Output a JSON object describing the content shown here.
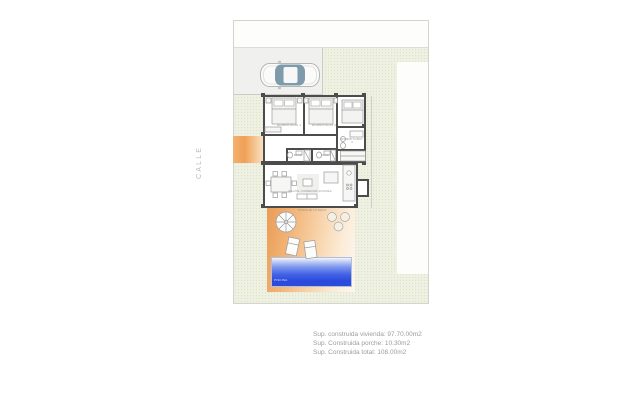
{
  "street_label": "CALLE",
  "legend": {
    "line1": "Sup. construida vivienda: 97.70.00m2",
    "line2": "Sup. Construida porche: 10.30m2",
    "line3": "Sup. Construida total: 108.00m2"
  },
  "rooms": {
    "bedroom1": "DORMITORIO 1",
    "bedroom2": "DORMITORIO 2",
    "bedroom3": "DORMITORIO 3",
    "bath1": "BAÑO",
    "bath2": "BAÑO",
    "living": "SALÓN-COMEDOR-COCINA",
    "porch": "PORCHE 10.30m2",
    "pool": "PISCINA"
  },
  "colors": {
    "garden_green": "#eef1e2",
    "porch_orange": "#efa055",
    "pool_blue": "#2b4ade",
    "wall_gray": "#4c4c4c",
    "car_glass": "#7d9bab"
  }
}
